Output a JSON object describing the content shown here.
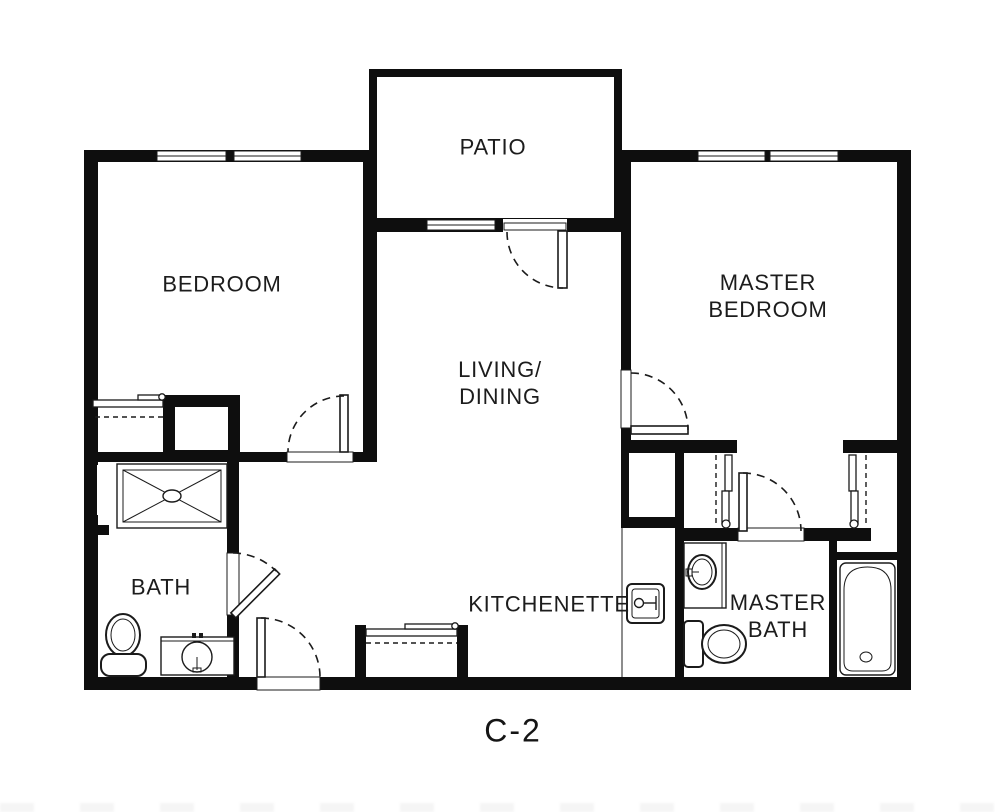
{
  "plan": {
    "code": "C-2",
    "kind": "apartment floor plan"
  },
  "rooms": {
    "patio": {
      "label": "PATIO"
    },
    "bedroom": {
      "label": "BEDROOM"
    },
    "living_dining": {
      "label": "LIVING/\nDINING"
    },
    "master_bedroom": {
      "label": "MASTER\nBEDROOM"
    },
    "bath": {
      "label": "BATH"
    },
    "kitchenette": {
      "label": "KITCHENETTE"
    },
    "master_bath": {
      "label": "MASTER\nBATH"
    }
  },
  "fixtures": [
    "shower-pan",
    "bath-toilet",
    "bath-vanity-sink",
    "kitchenette-sink",
    "master-vanity-sink",
    "master-toilet",
    "bathtub"
  ],
  "colors": {
    "background": "#ffffff",
    "wall": "#0e0e0e",
    "line": "#1b1b1b",
    "text": "#1c1c1c"
  }
}
